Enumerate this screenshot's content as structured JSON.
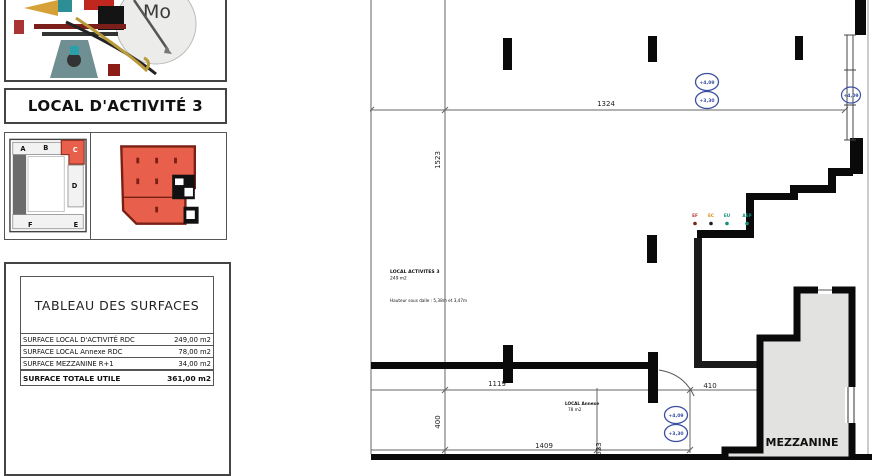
{
  "panel": {
    "logo_text": "Mo",
    "title": "LOCAL D'ACTIVITÉ 3",
    "site_plan_labels": {
      "a": "A",
      "b": "B",
      "c": "C",
      "d": "D",
      "e": "E",
      "f": "F"
    }
  },
  "surface_table": {
    "title": "TABLEAU DES SURFACES",
    "rows": [
      {
        "label": "SURFACE LOCAL D'ACTIVITÉ RDC",
        "value": "249,00 m2"
      },
      {
        "label": "SURFACE LOCAL Annexe RDC",
        "value": "78,00 m2"
      },
      {
        "label": "SURFACE MEZZANINE R+1",
        "value": "34,00 m2"
      }
    ],
    "total": {
      "label": "SURFACE TOTALE UTILE",
      "value": "361,00 m2"
    }
  },
  "plan": {
    "room": {
      "name": "LOCAL ACTIVITES 3",
      "area": "249 m2",
      "height_note": "Hauteur sous dalle : 5,38m et 3,47m"
    },
    "annexe": {
      "name": "LOCAL Annexe",
      "area": "78 m2"
    },
    "mezzanine_label": "MEZZANINE",
    "dims": {
      "top": "1324",
      "left": "1523",
      "annexe_top": "1119",
      "annexe_left": "400",
      "bottom": "1409",
      "small_right": "623",
      "door": "410"
    },
    "levels": {
      "upper": "+4,09",
      "lower": "+3,30"
    },
    "utilities": [
      {
        "label": "EF",
        "color": "#b03a2e",
        "dot": "#7b241c"
      },
      {
        "label": "EC",
        "color": "#d68910",
        "dot": "#1c1c1c"
      },
      {
        "label": "EU",
        "color": "#148f77",
        "dot": "#148f77"
      },
      {
        "label": "AEP",
        "color": "#148f77",
        "dot": "#148f77"
      }
    ],
    "colors": {
      "level": "#3a4fa0",
      "mezzanine_fill": "#e2e2e0",
      "unit_red": "#e8604c"
    }
  }
}
